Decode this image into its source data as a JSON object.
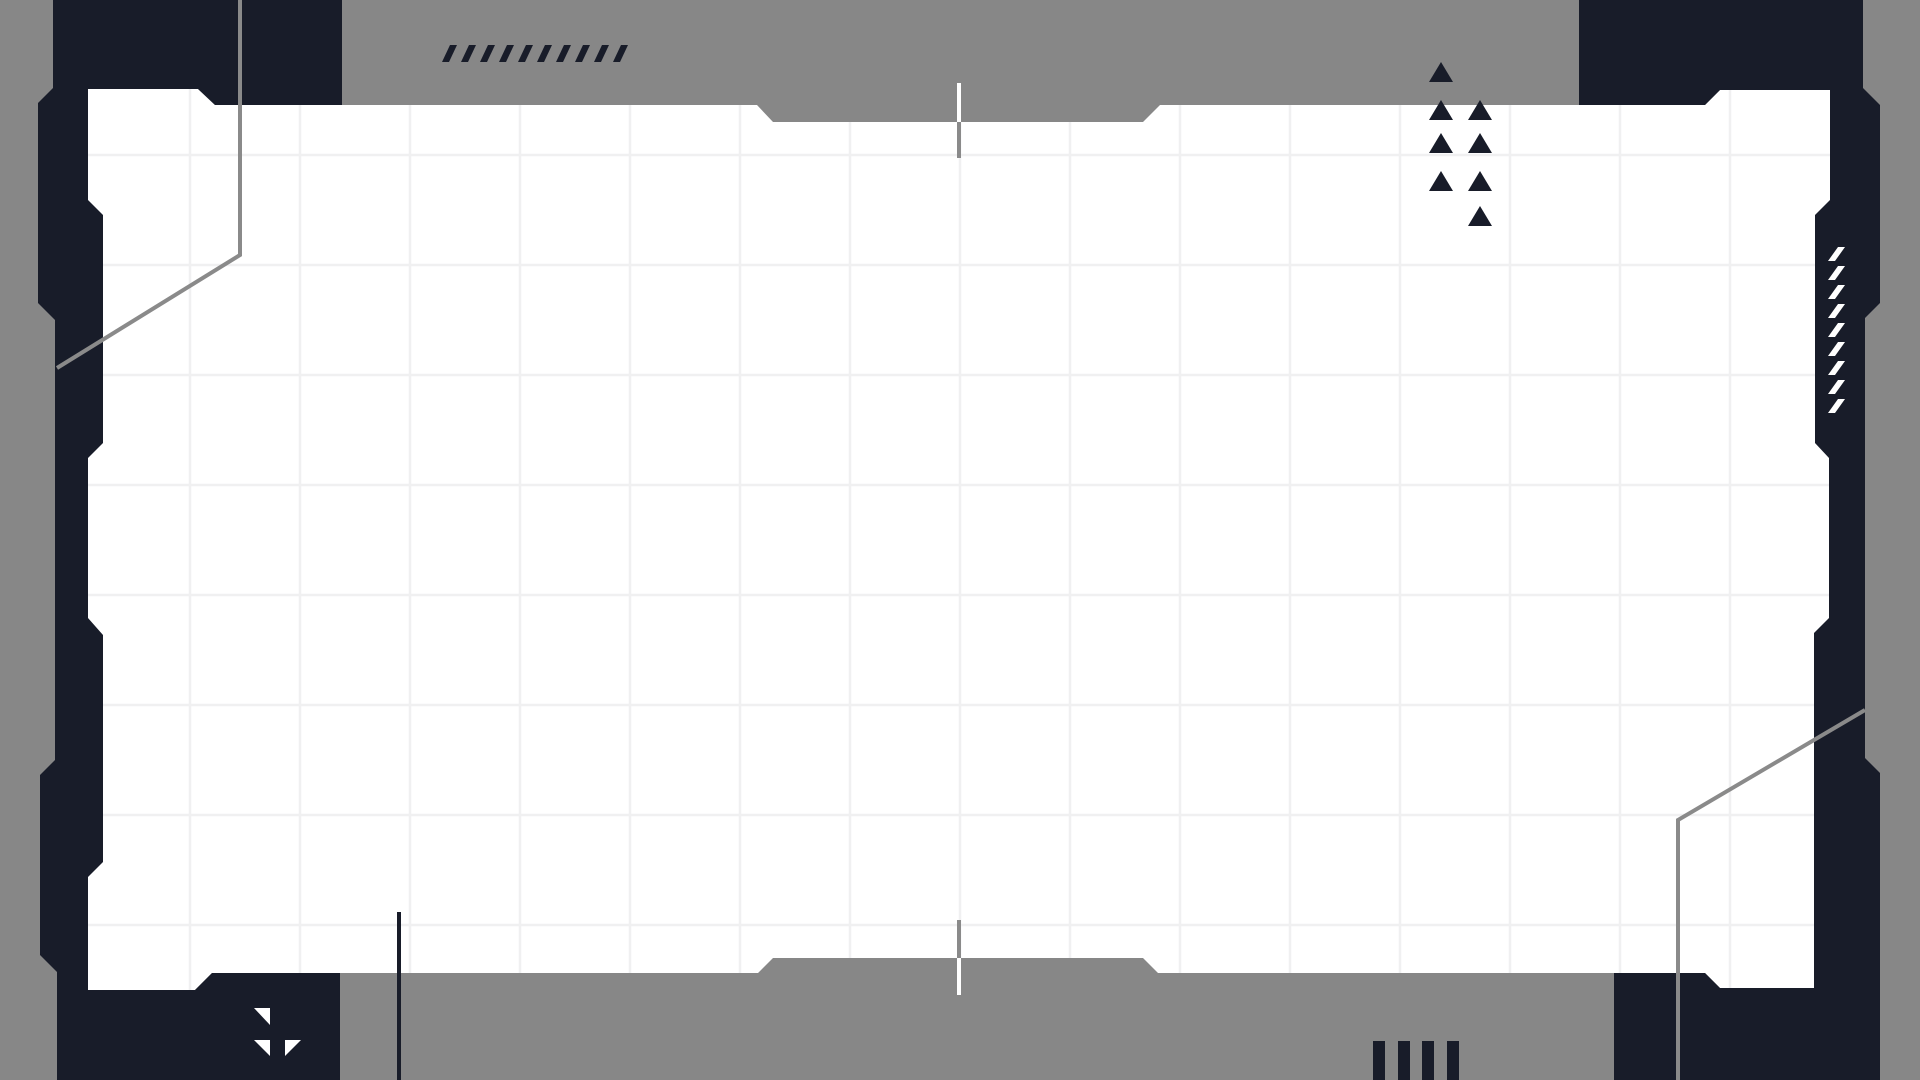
{
  "canvas": {
    "width": 1920,
    "height": 1080
  },
  "colors": {
    "bg": "#878787",
    "dark": "#181c29",
    "white": "#ffffff",
    "grid": "#f0f0f1",
    "accent_line": "#8a8a8a"
  },
  "panel": {
    "points": "88,89 198,89 215,105 757,105 773,122 1143,122 1160,105 1705,105 1720,90 1830,90 1830,988 1720,988 1705,973 1158,973 1143,958 773,958 758,973 212,973 195,990 88,990"
  },
  "grid": {
    "vertical_x": [
      190,
      300,
      410,
      520,
      630,
      740,
      850,
      960,
      1070,
      1180,
      1290,
      1400,
      1510,
      1620,
      1730
    ],
    "horizontal_y": [
      155,
      265,
      375,
      485,
      595,
      705,
      815,
      925
    ],
    "stroke_width": 2.5
  },
  "frame": {
    "left_bracket_points": "53,0 342,0 342,105 215,105 198,89 88,89 88,200 103,215 103,443 88,458 88,618 103,635 103,862 88,877 88,990 195,990 212,973 340,973 340,1080 57,1080 57,972 40,955 40,775 55,760 55,320 38,303 38,103 53,88",
    "right_bracket_points": "1579,0 1863,0 1863,88 1880,105 1880,303 1865,318 1865,758 1880,773 1880,1080 1614,1080 1614,973 1705,973 1720,988 1814,988 1814,633 1829,618 1829,458 1815,443 1815,215 1830,200 1830,90 1720,90 1705,105 1579,105"
  },
  "accent_lines": {
    "stroke_width": 4,
    "top_left_points": "240,0 240,255 57,368",
    "bottom_right_points": "1865,710 1678,820 1678,1080"
  },
  "ticks": {
    "top_white": {
      "x": 957,
      "y": 83,
      "w": 4,
      "h": 39
    },
    "top_gray": {
      "x": 957,
      "y": 122,
      "w": 4,
      "h": 36
    },
    "bottom_gray": {
      "x": 957,
      "y": 920,
      "w": 4,
      "h": 38
    },
    "bottom_white": {
      "x": 957,
      "y": 958,
      "w": 4,
      "h": 37
    }
  },
  "hazard_slashes_dark": [
    "442,62 449,62 457,45 450,45",
    "461,62 468,62 476,45 469,45",
    "480,62 487,62 495,45 488,45",
    "499,62 506,62 514,45 507,45",
    "518,62 525,62 533,45 526,45",
    "537,62 544,62 552,45 545,45",
    "556,62 563,62 571,45 564,45",
    "575,62 582,62 590,45 583,45",
    "594,62 601,62 609,45 602,45",
    "613,62 620,62 628,45 621,45"
  ],
  "hazard_slashes_white": [
    "1828,261 1835,261 1845,247 1838,247",
    "1828,280 1835,280 1845,266 1838,266",
    "1828,299 1835,299 1845,285 1838,285",
    "1828,318 1835,318 1845,304 1838,304",
    "1828,337 1835,337 1845,323 1838,323",
    "1828,356 1835,356 1845,342 1838,342",
    "1828,375 1835,375 1845,361 1838,361",
    "1828,394 1835,394 1845,380 1838,380",
    "1828,413 1835,413 1845,399 1838,399"
  ],
  "triangle_cluster": [
    "1429,82 1453,82 1441,62",
    "1429,120 1453,120 1441,100",
    "1468,120 1492,120 1480,100",
    "1429,153 1453,153 1441,133",
    "1468,153 1492,153 1480,133",
    "1429,191 1453,191 1441,171",
    "1468,191 1492,191 1480,171",
    "1468,226 1492,226 1480,206"
  ],
  "corner_glyph_triangles": [
    "254,1008 270,1008 270,1025",
    "254,1040 270,1040 270,1056",
    "285,1040 301,1040 285,1056"
  ],
  "bottom_bars": [
    {
      "x": 1373,
      "y": 1041,
      "w": 12,
      "h": 39
    },
    {
      "x": 1398,
      "y": 1041,
      "w": 12,
      "h": 39
    },
    {
      "x": 1422,
      "y": 1041,
      "w": 12,
      "h": 39
    },
    {
      "x": 1447,
      "y": 1041,
      "w": 12,
      "h": 39
    }
  ],
  "bottom_left_rule": {
    "x": 397,
    "y": 912,
    "w": 4,
    "h": 168
  }
}
